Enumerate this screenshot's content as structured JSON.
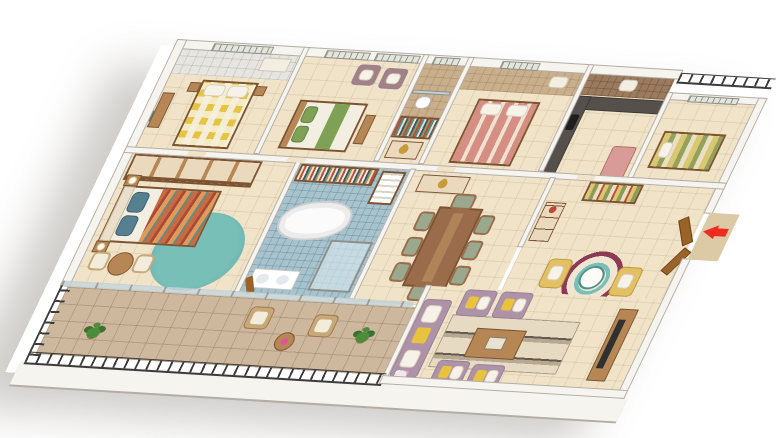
{
  "scene": {
    "type": "isometric-3d-floor-plan",
    "description": "3D isometric cutaway rendering of a large 4-bedroom apartment: three bedrooms and kitchen along the back, master suite with walk-in bath at center-left, dining hall and entrance foyer at center-right, mauve-sofa living room at bottom-right, and a long stone-tiled balcony with black iron railing across the front. A red arrow marks the entrance door.",
    "background": "#ffffff",
    "visible_text": ""
  },
  "entrance": {
    "marker": "red-arrow",
    "direction": "left-into-foyer"
  },
  "palette": {
    "bg": "#ffffff",
    "floor": "#f0e3c7",
    "balconyFloor": "#cdb79d",
    "utilityTile": "#9b7a5e",
    "tanTile": "#c9af8c",
    "wall": "#f6f4ef",
    "wallEdge": "#b5ada5",
    "winFrame": "#8f8f8a",
    "winPane": "#e2e5da",
    "glass": "#c4d1d4",
    "railing": "#3b3b3b",
    "tealRug": "#78bfb8",
    "tealRugDark": "#5fa8a4",
    "headboard": "#e9dfcb",
    "pillowTeal": "#567f90",
    "duvetOrange": "#c96a41",
    "duvetOrangeDark": "#a84a38",
    "duvetOrangeLight": "#e09a5a",
    "duvetTeal": "#5b8e8a",
    "yellowBed": "#e6c443",
    "bedWhite": "#f3eee2",
    "greenRunner": "#7fa155",
    "mauveChair": "#a08287",
    "pinkBed": "#d68e84",
    "counter": "#55504b",
    "wood": "#b68755",
    "woodDark": "#7c5432",
    "tableWood": "#9a6c4b",
    "doorWood": "#9a6428",
    "fridgePink": "#d89b97",
    "mattressYellow": "#d9c871",
    "mattressGreen": "#93a15d",
    "seatGreen": "#9aa88e",
    "consoleCream": "#ead9bd",
    "statueGold": "#c69b3c",
    "arrowRed": "#ee2b1c",
    "foyerChairYellow": "#e2c063",
    "rugMaroon": "#8e3a55",
    "rugCream": "#efe5d2",
    "sofaMauve": "#ae92a8",
    "sofaMauveDark": "#9a7f95",
    "cushionYellow": "#eac33e",
    "rugBandLight": "#e6dac3",
    "rugBandMid": "#b7a891",
    "rugBandDark": "#655a4c",
    "tvDark": "#303030",
    "tubWhite": "#fbfbfb",
    "bathBlue": "#a7c3cd",
    "plantGreen": "#4c8c3c",
    "plantDark": "#3c7030",
    "wicker": "#c8a878",
    "cushionCream": "#f2ecdc",
    "accentRed": "#c04838",
    "accentTeal": "#4f8f8a",
    "accentOlive": "#8f9a5a",
    "accentNavy": "#3f5570"
  },
  "rooms": [
    {
      "id": "bedroom-1",
      "name": "bedroom-yellow",
      "items": [
        "double-bed-yellow-checkered-duvet",
        "white-pillows",
        "nightstands",
        "dresser",
        "green-wall-art",
        "attached-bathroom-vanity"
      ]
    },
    {
      "id": "bedroom-2",
      "name": "bedroom-green",
      "items": [
        "bed-white-with-green-runner",
        "green-pillows",
        "two-mauve-armchairs-white-cushions",
        "window-blinds",
        "foot-bench"
      ]
    },
    {
      "id": "bathroom-2",
      "name": "common-toilet",
      "items": [
        "toilet",
        "glass-partition",
        "beige-mosaic-tiles"
      ]
    },
    {
      "id": "wardrobe-hall",
      "name": "wardrobe-passage",
      "items": [
        "open-wardrobe-hanging-clothes",
        "dresser-with-gold-ganesha-statue"
      ]
    },
    {
      "id": "bedroom-3",
      "name": "bedroom-pink",
      "items": [
        "bed-pink-cream-striped-duvet",
        "pillows",
        "attached-tan-tiled-bathroom-with-basin"
      ]
    },
    {
      "id": "kitchen",
      "name": "kitchen",
      "items": [
        "L-shaped-dark-countertop",
        "gas-stove",
        "pink-refrigerator",
        "utility-wash-basin",
        "brown-tiled-wall"
      ]
    },
    {
      "id": "servant-room",
      "name": "utility-bedroom",
      "items": [
        "striped-yellow-green-mattress",
        "dry-balcony-railing"
      ]
    },
    {
      "id": "master-bedroom",
      "name": "master-bedroom",
      "items": [
        "wardrobe-with-open-shelves",
        "cream-tufted-headboard-bed",
        "multicolor-orange-teal-duvet",
        "teal-pillows",
        "nightstands-with-lamps",
        "teal-round-rug",
        "round-table-with-two-chairs"
      ]
    },
    {
      "id": "master-bath",
      "name": "master-bathroom",
      "items": [
        "freestanding-white-bathtub",
        "blue-mosaic-tiles",
        "glass-shower-cubicle",
        "twin-wash-basins",
        "toiletries-shelf",
        "towel-rack",
        "wooden-door"
      ]
    },
    {
      "id": "dining",
      "name": "dining-hall",
      "items": [
        "eight-seat-wooden-dining-table",
        "green-seat-chairs",
        "console-with-gold-statue"
      ]
    },
    {
      "id": "foyer",
      "name": "entrance-foyer",
      "items": [
        "open-wooden-double-door",
        "red-entry-arrow",
        "striped-shoe-rack",
        "chest-of-drawers",
        "maroon-ring-round-rug",
        "two-yellow-accent-chairs",
        "small-round-table"
      ]
    },
    {
      "id": "balcony",
      "name": "balcony",
      "items": [
        "stone-tile-floor",
        "black-iron-railing",
        "potted-plants",
        "two-wicker-armchairs",
        "round-side-table",
        "sliding-glass-doors"
      ]
    },
    {
      "id": "living",
      "name": "living-room",
      "items": [
        "mauve-three-seat-sofa",
        "four-mauve-armchairs",
        "yellow-white-cushions",
        "wooden-coffee-table",
        "striped-band-rug",
        "tv-unit-with-flatscreen",
        "flower-vase"
      ]
    }
  ]
}
